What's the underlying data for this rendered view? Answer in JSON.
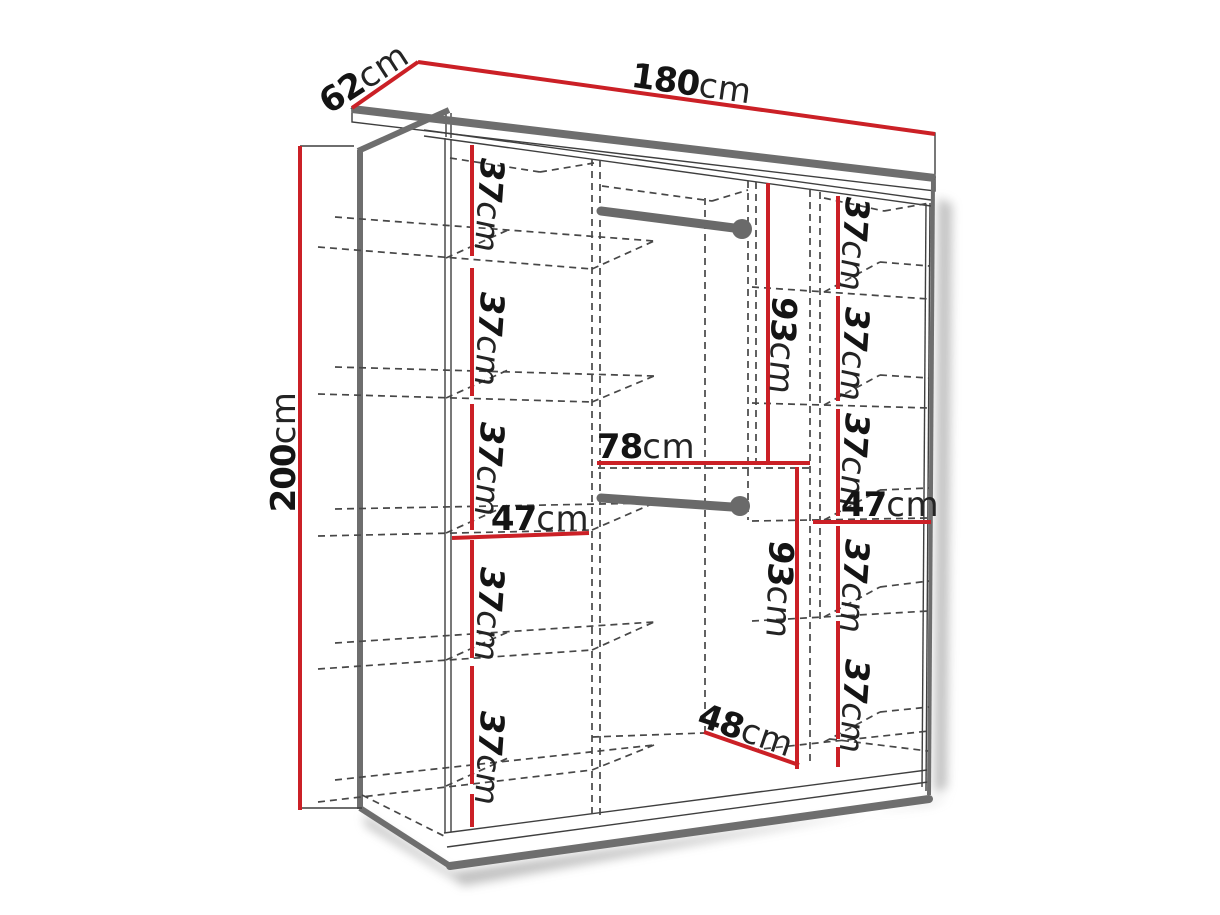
{
  "colors": {
    "dimension_line": "#cb2026",
    "structure_line": "#6e6e6e",
    "hidden_dashed_line": "#474747",
    "label_text": "#141414",
    "background": "#ffffff"
  },
  "labels": {
    "width": {
      "value": "180",
      "unit": "cm"
    },
    "depth": {
      "value": "62",
      "unit": "cm"
    },
    "height": {
      "value": "200",
      "unit": "cm"
    },
    "left_column_width": {
      "value": "47",
      "unit": "cm"
    },
    "right_column_width": {
      "value": "47",
      "unit": "cm"
    },
    "middle_top_width": {
      "value": "78",
      "unit": "cm"
    },
    "middle_bottom_width": {
      "value": "48",
      "unit": "cm"
    },
    "top_hanging_height": {
      "value": "93",
      "unit": "cm"
    },
    "bottom_hanging_height": {
      "value": "93",
      "unit": "cm"
    },
    "left_shelf_gaps": [
      {
        "value": "37",
        "unit": "cm"
      },
      {
        "value": "37",
        "unit": "cm"
      },
      {
        "value": "37",
        "unit": "cm"
      },
      {
        "value": "37",
        "unit": "cm"
      },
      {
        "value": "37",
        "unit": "cm"
      }
    ],
    "right_shelf_gaps": [
      {
        "value": "37",
        "unit": "cm"
      },
      {
        "value": "37",
        "unit": "cm"
      },
      {
        "value": "37",
        "unit": "cm"
      },
      {
        "value": "37",
        "unit": "cm"
      },
      {
        "value": "37",
        "unit": "cm"
      }
    ]
  }
}
